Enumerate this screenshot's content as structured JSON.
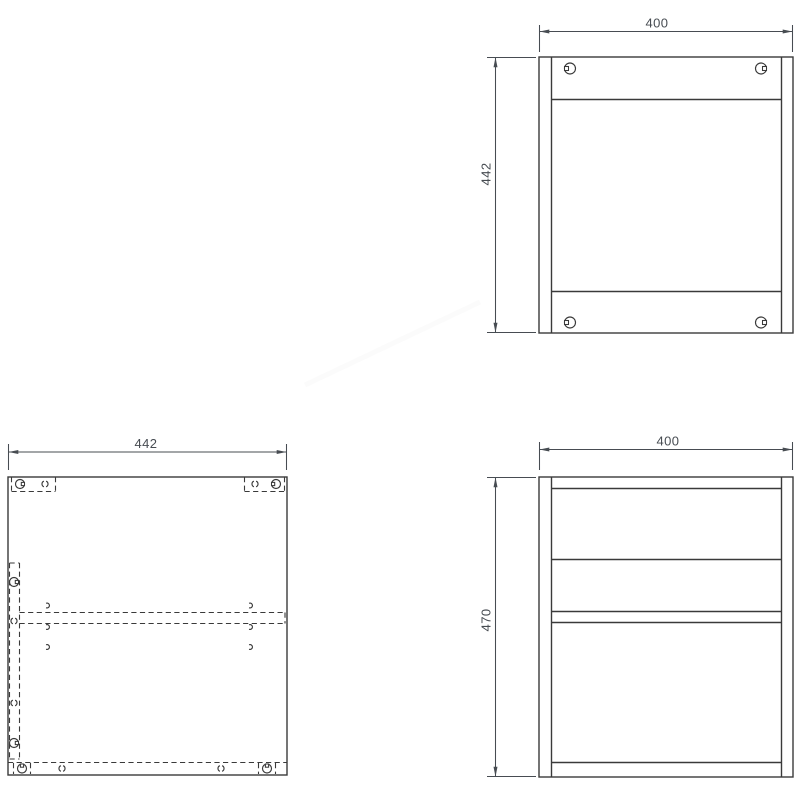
{
  "colors": {
    "line": "#3a3a3a",
    "dim": "#474c52",
    "background": "#ffffff",
    "watermark": "#fbfbfb"
  },
  "views": {
    "back_panel": {
      "width": "400",
      "height": "442"
    },
    "side_panel": {
      "width": "442"
    },
    "front_frame": {
      "width": "400",
      "height": "470"
    }
  }
}
